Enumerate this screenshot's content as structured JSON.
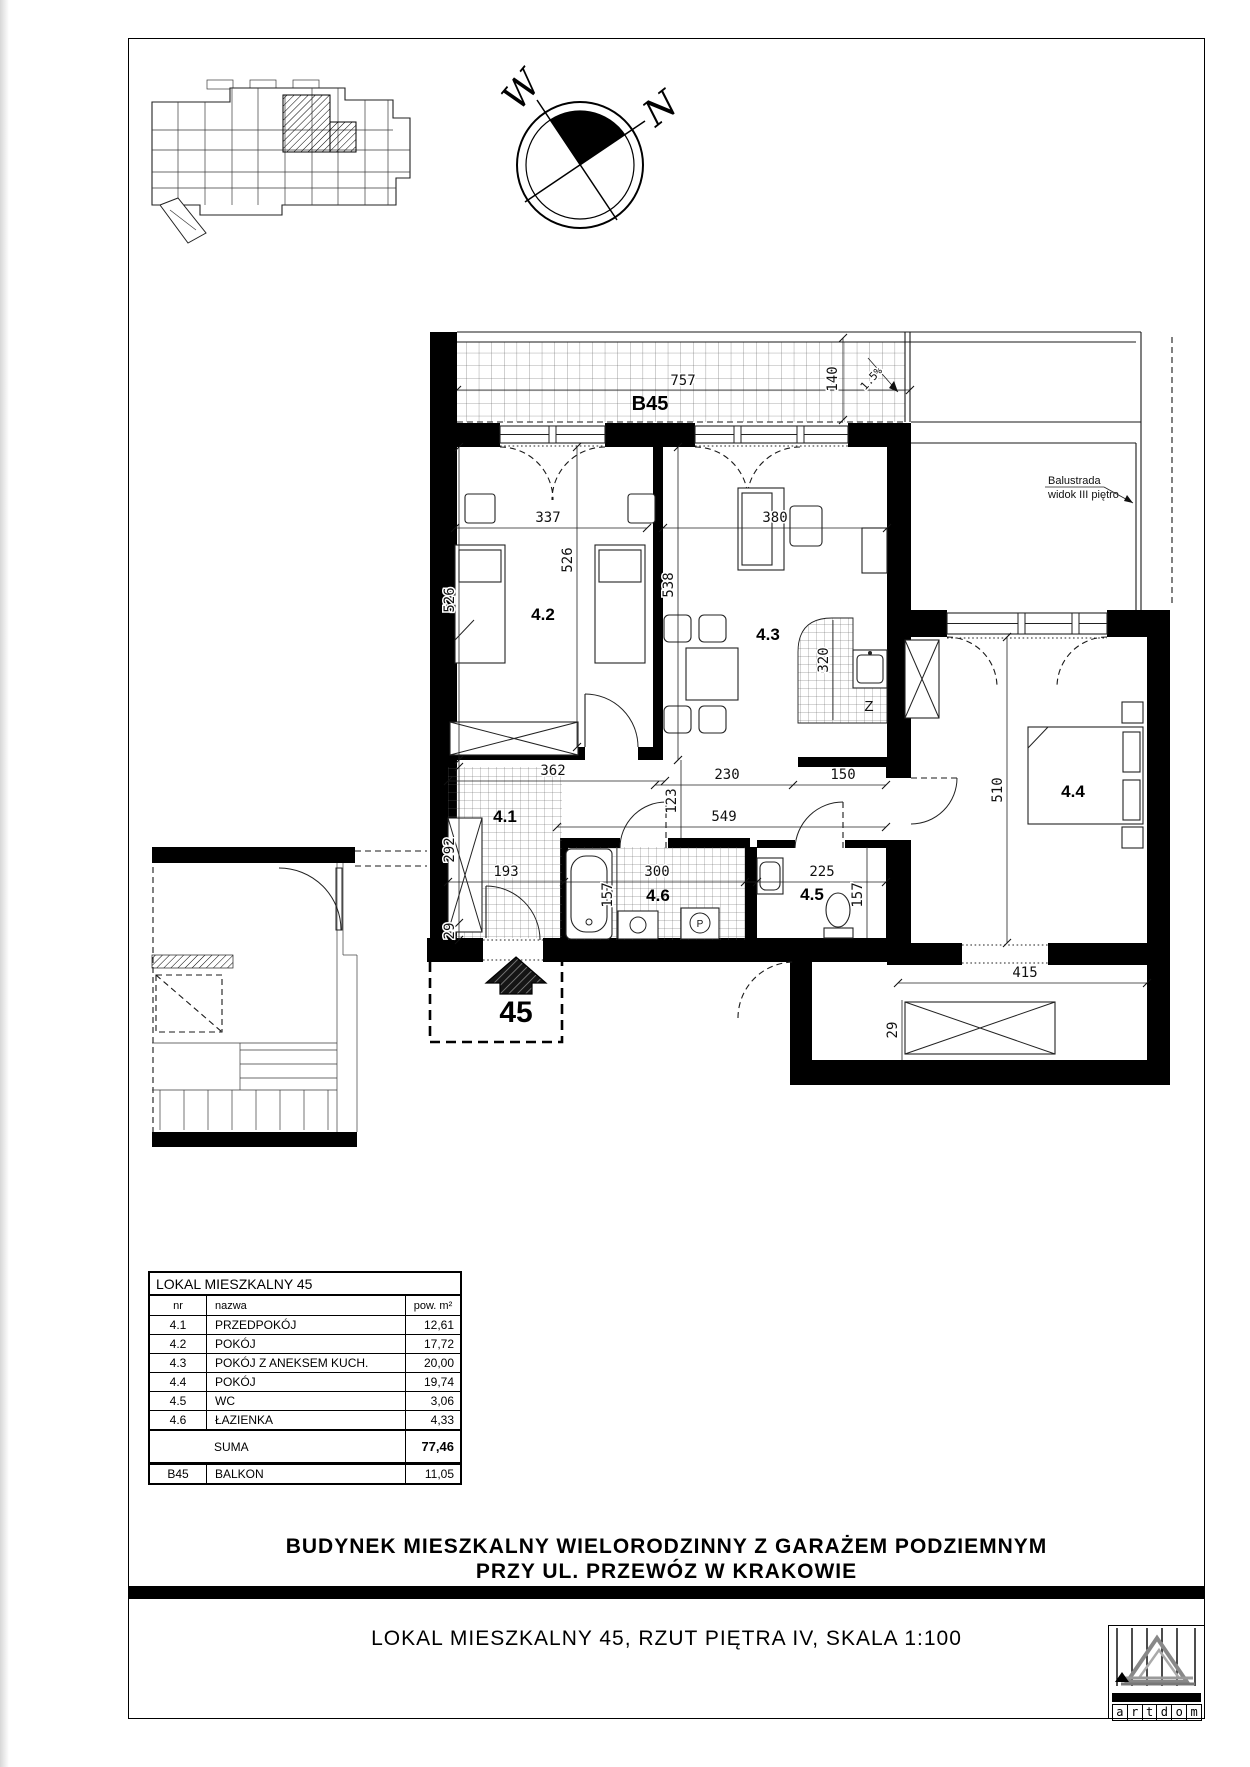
{
  "compass": {
    "west": "W",
    "north": "N"
  },
  "plan": {
    "balcony_label": "B45",
    "sink_label": "Z",
    "washer_label": "P",
    "entrance_number": "45",
    "note_balustrade_1": "Balustrada",
    "note_balustrade_2": "widok III piętro",
    "rooms": {
      "r41": "4.1",
      "r42": "4.2",
      "r43": "4.3",
      "r44": "4.4",
      "r45": "4.5",
      "r46": "4.6"
    },
    "dims": {
      "d757": "757",
      "d140": "140",
      "slope": "1.5%",
      "d337": "337",
      "d526": "526",
      "d380": "380",
      "d538": "538",
      "d320": "320",
      "d362": "362",
      "d292": "292",
      "d29": "29",
      "d193": "193",
      "d230": "230",
      "d123": "123",
      "d549": "549",
      "d150": "150",
      "d300": "300",
      "d157": "157",
      "d225": "225",
      "d510": "510",
      "d415": "415"
    }
  },
  "table": {
    "title": "LOKAL MIESZKALNY 45",
    "col_nr": "nr",
    "col_nazwa": "nazwa",
    "col_pow": "pow. m²",
    "rows": [
      {
        "nr": "4.1",
        "nazwa": "PRZEDPOKÓJ",
        "pow": "12,61"
      },
      {
        "nr": "4.2",
        "nazwa": "POKÓJ",
        "pow": "17,72"
      },
      {
        "nr": "4.3",
        "nazwa": "POKÓJ Z ANEKSEM KUCH.",
        "pow": "20,00"
      },
      {
        "nr": "4.4",
        "nazwa": "POKÓJ",
        "pow": "19,74"
      },
      {
        "nr": "4.5",
        "nazwa": "WC",
        "pow": "3,06"
      },
      {
        "nr": "4.6",
        "nazwa": "ŁAZIENKA",
        "pow": "4,33"
      }
    ],
    "suma_label": "SUMA",
    "suma_value": "77,46",
    "balkon_nr": "B45",
    "balkon_nazwa": "BALKON",
    "balkon_pow": "11,05"
  },
  "titles": {
    "project_line1": "BUDYNEK MIESZKALNY WIELORODZINNY Z GARAŻEM PODZIEMNYM",
    "project_line2": "PRZY UL. PRZEWÓZ W KRAKOWIE",
    "sheet_title": "LOKAL MIESZKALNY 45, RZUT PIĘTRA IV, SKALA 1:100"
  },
  "logo": {
    "letters": [
      "a",
      "r",
      "t",
      "d",
      "o",
      "m"
    ]
  }
}
